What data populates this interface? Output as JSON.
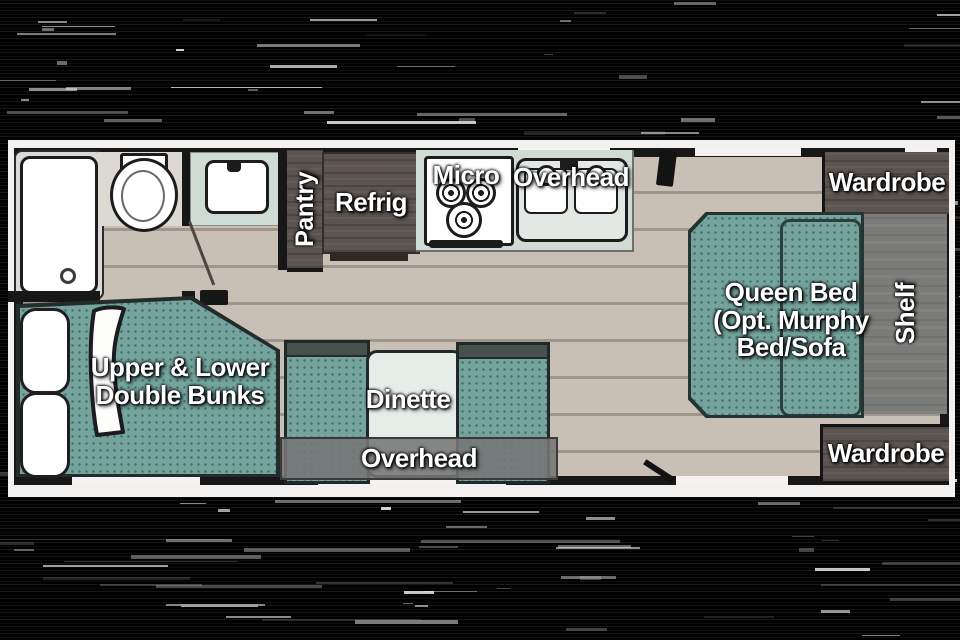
{
  "floorplan": {
    "bathroom": {
      "pantry": "Pantry"
    },
    "kitchen": {
      "refrig": "Refrig",
      "micro": "Micro",
      "overhead": "Overhead"
    },
    "bedroom": {
      "wardrobe_top": "Wardrobe",
      "wardrobe_bottom": "Wardrobe",
      "shelf": "Shelf",
      "queen_bed": {
        "line1": "Queen Bed",
        "line2": "(Opt. Murphy",
        "line3": "Bed/Sofa"
      }
    },
    "dinette": {
      "label": "Dinette",
      "overhead": "Overhead"
    },
    "bunks": {
      "line1": "Upper & Lower",
      "line2": "Double Bunks"
    }
  },
  "colors": {
    "background": "#000000",
    "page_white": "#f2f1ef",
    "wall_black": "#171717",
    "floor": "#c8bfb5",
    "plank_line": "#9e958b",
    "furniture_teal": "#74a49d",
    "furniture_teal_dot": "#4a746e",
    "counter_teal": "#cfdbd5",
    "cabinet_dark": "#5b5450",
    "shelf_gray": "#7b7b79",
    "label_text": "#ffffff"
  }
}
